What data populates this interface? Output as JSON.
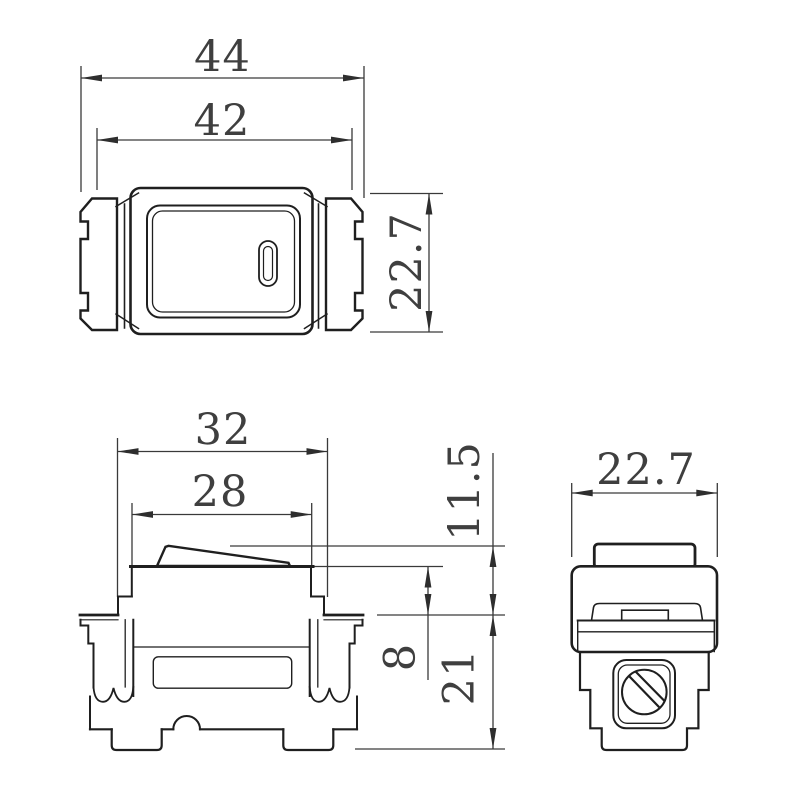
{
  "dims": {
    "front": {
      "overall_width": "44",
      "inner_width": "42",
      "height": "22.7"
    },
    "side": {
      "frame_width": "32",
      "plate_width": "28",
      "rocker_protrusion": "11.5",
      "plate_depth": "8",
      "mount_depth": "21"
    },
    "end": {
      "width": "22.7"
    }
  }
}
